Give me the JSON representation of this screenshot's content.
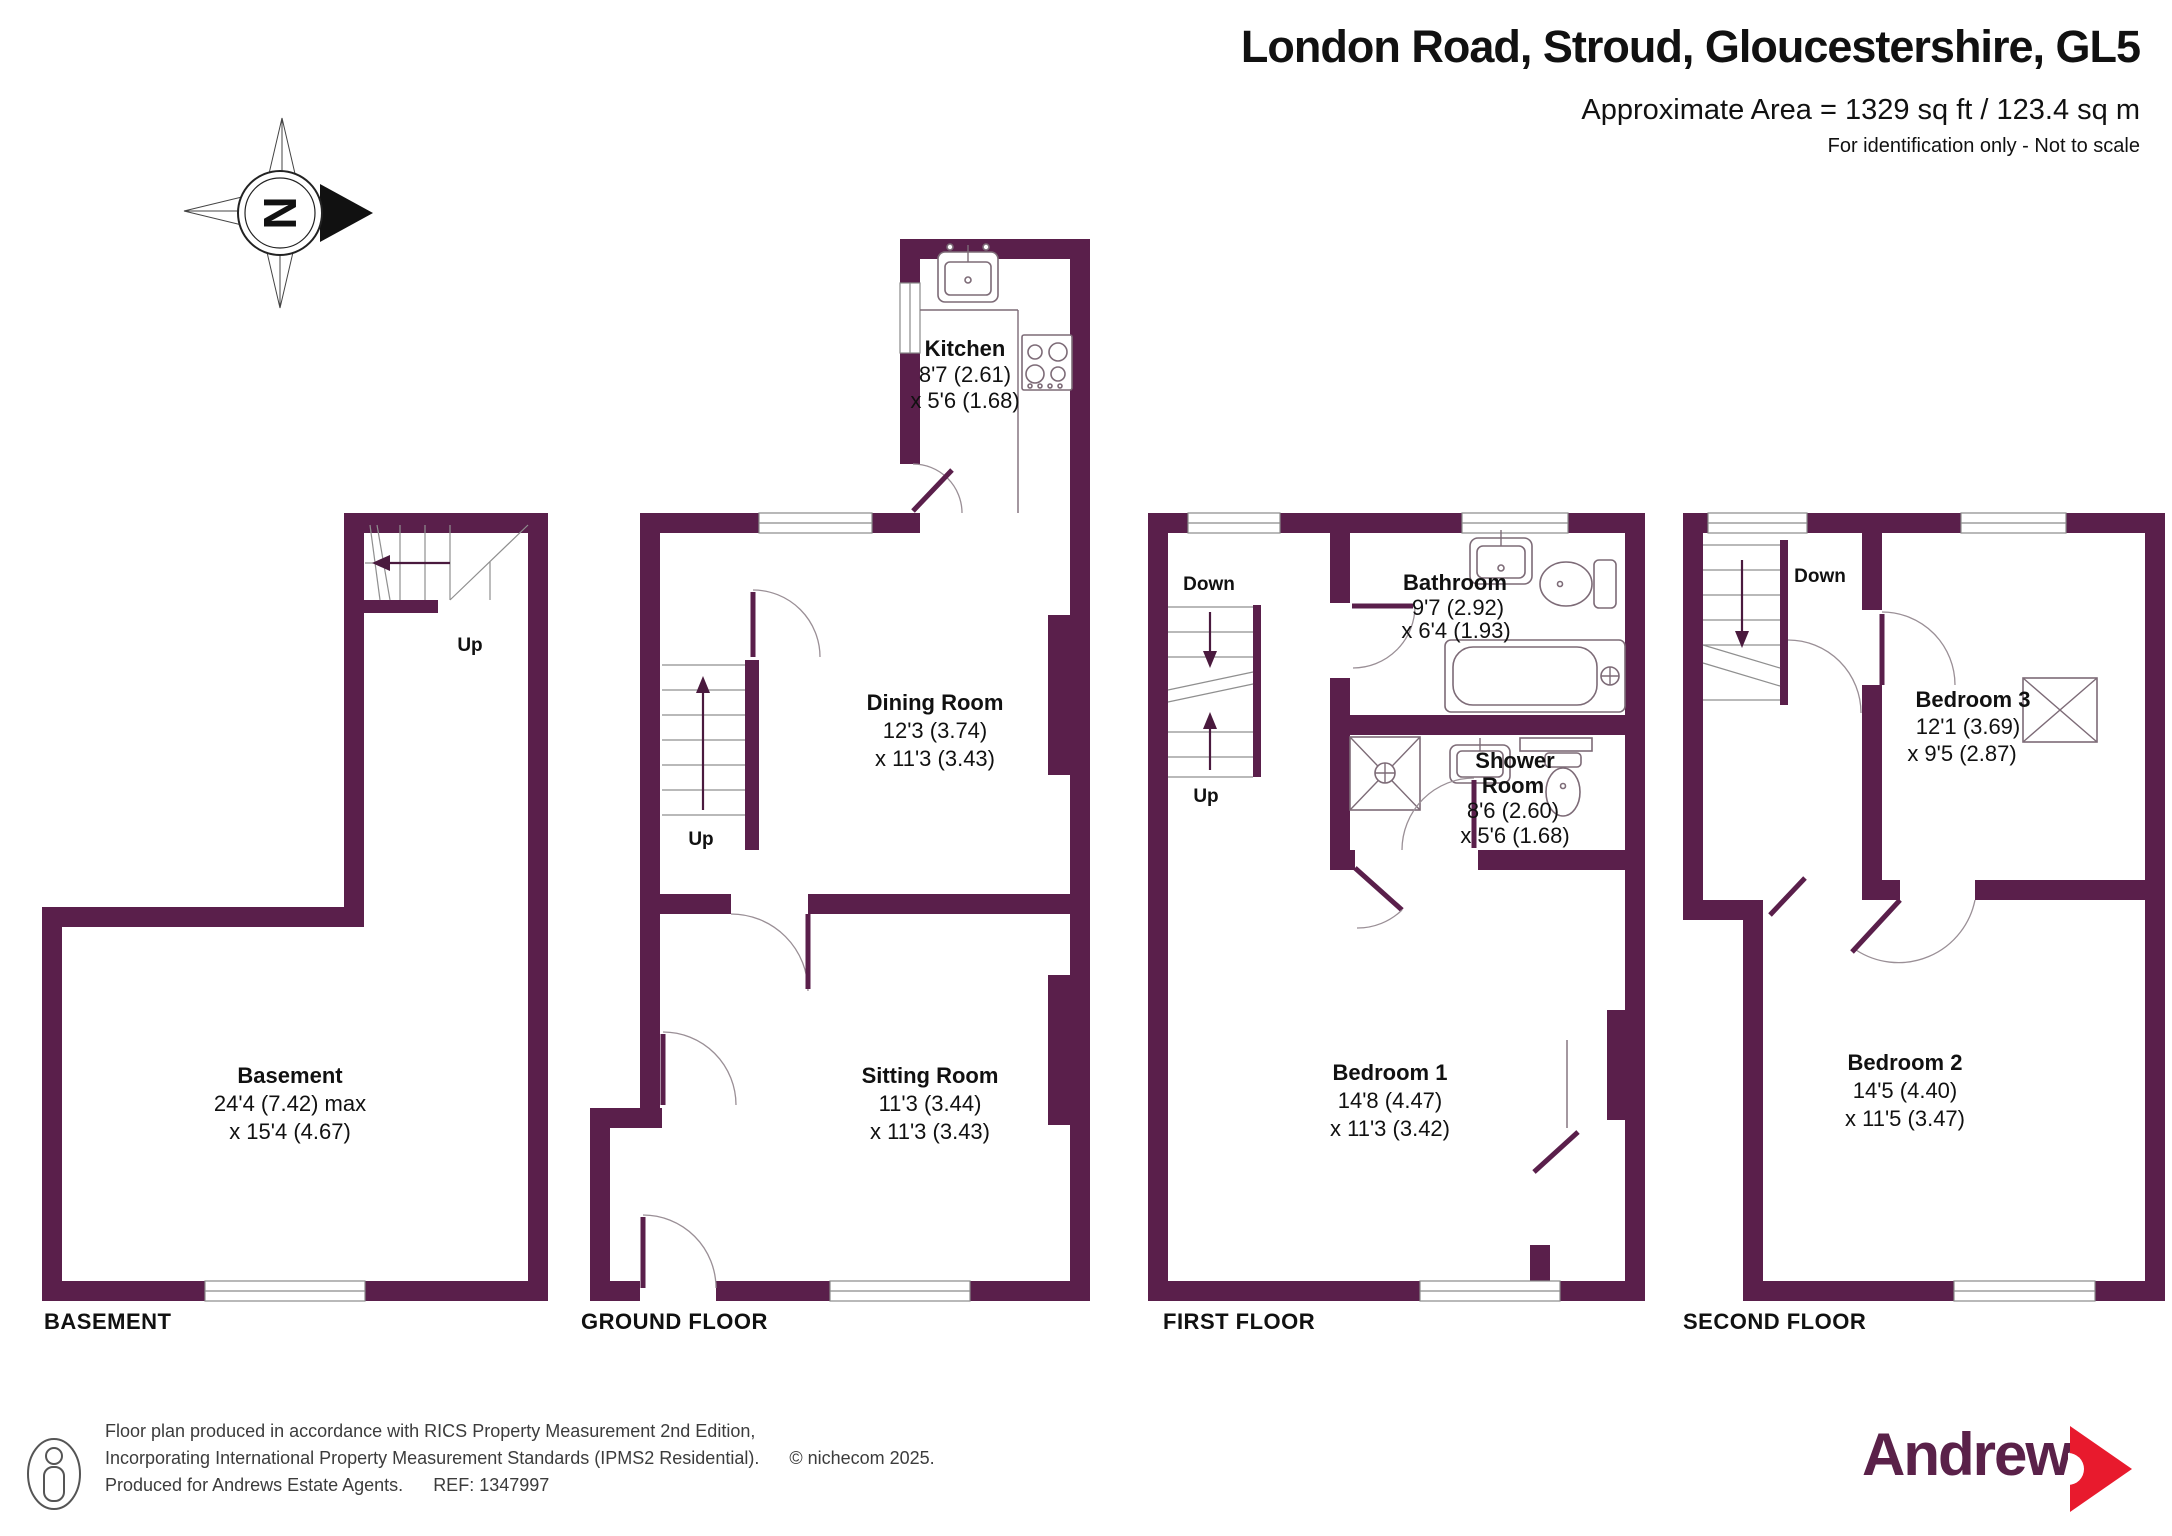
{
  "header": {
    "title": "London Road, Stroud, Gloucestershire, GL5",
    "area": "Approximate Area = 1329 sq ft / 123.4 sq m",
    "disclaimer": "For identification only - Not to scale"
  },
  "compass": {
    "north": "N"
  },
  "floor_labels": {
    "basement": "BASEMENT",
    "ground": "GROUND FLOOR",
    "first": "FIRST FLOOR",
    "second": "SECOND FLOOR"
  },
  "rooms": {
    "basement": {
      "name": "Basement",
      "dim1": "24'4 (7.42) max",
      "dim2": "x 15'4 (4.67)"
    },
    "kitchen": {
      "name": "Kitchen",
      "dim1": "8'7 (2.61)",
      "dim2": "x 5'6 (1.68)"
    },
    "dining_room": {
      "name": "Dining Room",
      "dim1": "12'3 (3.74)",
      "dim2": "x 11'3 (3.43)"
    },
    "sitting_room": {
      "name": "Sitting Room",
      "dim1": "11'3 (3.44)",
      "dim2": "x 11'3 (3.43)"
    },
    "bathroom": {
      "name": "Bathroom",
      "dim1": "9'7 (2.92)",
      "dim2": "x 6'4 (1.93)"
    },
    "shower_room": {
      "name_line1": "Shower",
      "name_line2": "Room",
      "dim1": "8'6 (2.60)",
      "dim2": "x 5'6 (1.68)"
    },
    "bedroom1": {
      "name": "Bedroom 1",
      "dim1": "14'8 (4.47)",
      "dim2": "x 11'3 (3.42)"
    },
    "bedroom2": {
      "name": "Bedroom 2",
      "dim1": "14'5 (4.40)",
      "dim2": "x 11'5 (3.47)"
    },
    "bedroom3": {
      "name": "Bedroom 3",
      "dim1": "12'1 (3.69)",
      "dim2": "x 9'5 (2.87)"
    }
  },
  "stairs": {
    "basement_up": "Up",
    "ground_up": "Up",
    "first_down": "Down",
    "first_up": "Up",
    "second_down": "Down"
  },
  "footer": {
    "line1": "Floor plan produced in accordance with RICS Property Measurement 2nd Edition,",
    "line2": "Incorporating International Property Measurement Standards (IPMS2 Residential).",
    "copyright": "© nichecom 2025.",
    "line3": "Produced for Andrews Estate Agents.",
    "ref": "REF: 1347997"
  },
  "brand": {
    "name": "Andrews"
  },
  "colors": {
    "wall": "#5a1f4b",
    "brand_text": "#5a2149",
    "brand_arrow": "#e81a2d"
  }
}
